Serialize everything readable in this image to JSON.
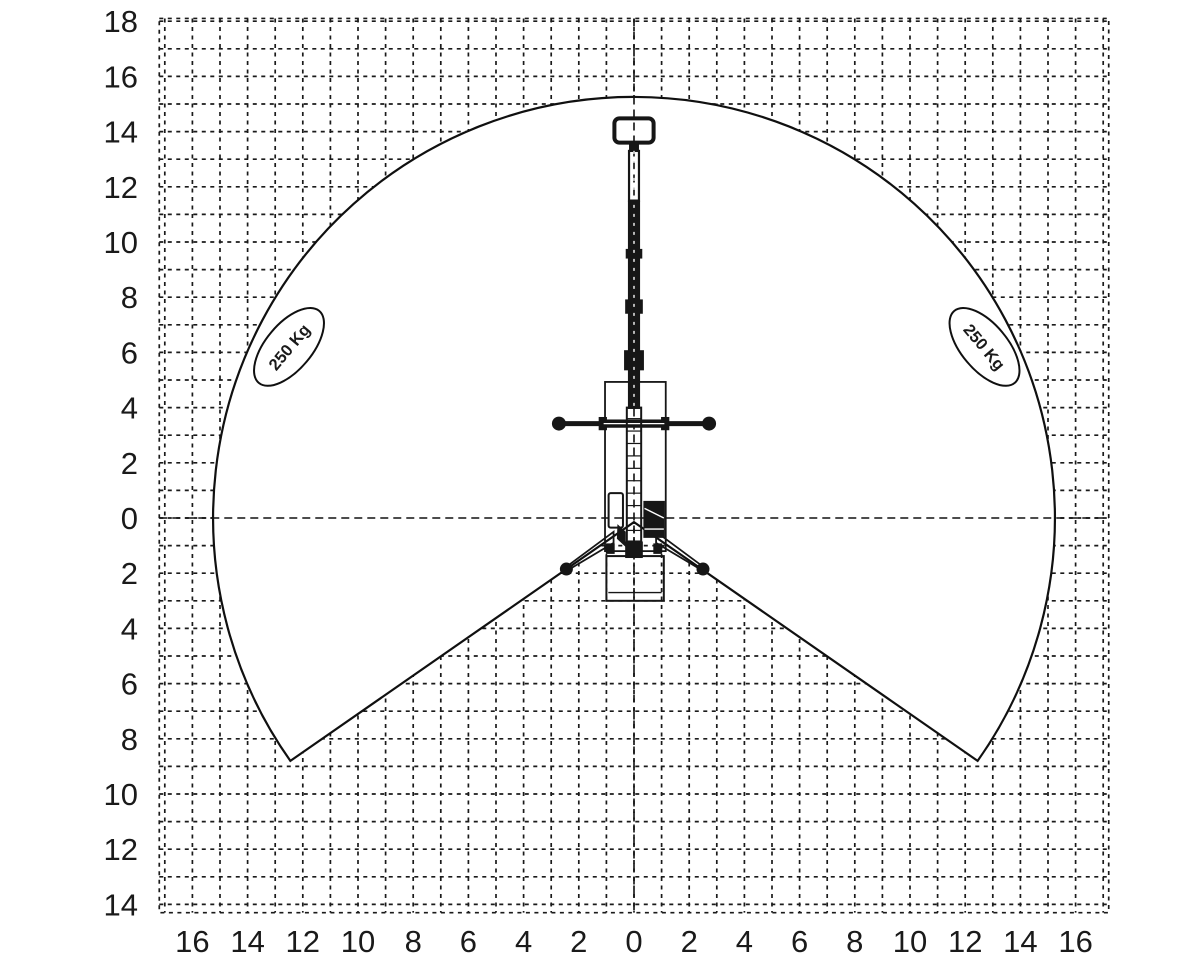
{
  "chart_data": {
    "type": "area",
    "description": "Working range / load envelope diagram (front view) of a telescopic boom lift on a 1 m dashed grid",
    "x_axis": {
      "tick_positions": [
        -16,
        -14,
        -12,
        -10,
        -8,
        -6,
        -4,
        -2,
        0,
        2,
        4,
        6,
        8,
        10,
        12,
        14,
        16
      ],
      "tick_labels": [
        "16",
        "14",
        "12",
        "10",
        "8",
        "6",
        "4",
        "2",
        "0",
        "2",
        "4",
        "6",
        "8",
        "10",
        "12",
        "14",
        "16"
      ],
      "range": [
        -17.2,
        17.2
      ]
    },
    "y_axis": {
      "tick_positions": [
        18,
        16,
        14,
        12,
        10,
        8,
        6,
        4,
        2,
        0,
        -2,
        -4,
        -6,
        -8,
        -10,
        -12,
        -14
      ],
      "tick_labels": [
        "18",
        "16",
        "14",
        "12",
        "10",
        "8",
        "6",
        "4",
        "2",
        "0",
        "2",
        "4",
        "6",
        "8",
        "10",
        "12",
        "14"
      ],
      "range": [
        -14.3,
        18.1
      ]
    },
    "grid": {
      "cell": 1,
      "style": "dashed"
    },
    "envelope": {
      "shape": "circle_with_bottom_notch",
      "center": [
        0,
        0
      ],
      "radius": 15.25,
      "notch_vertex": [
        0,
        -0.15
      ],
      "notch_corners": [
        [
          -12.45,
          -8.8
        ],
        [
          12.45,
          -8.8
        ]
      ]
    },
    "load_labels": [
      {
        "text": "250 Kg",
        "x": -12.5,
        "y": 6.2,
        "text_rotation_deg": -50,
        "bubble_rotation_deg": 40
      },
      {
        "text": "250 Kg",
        "x": 12.7,
        "y": 6.2,
        "text_rotation_deg": 50,
        "bubble_rotation_deg": -40
      }
    ],
    "machine": {
      "type": "telescopic boom lift, front view, boom fully raised, outriggers deployed"
    }
  }
}
